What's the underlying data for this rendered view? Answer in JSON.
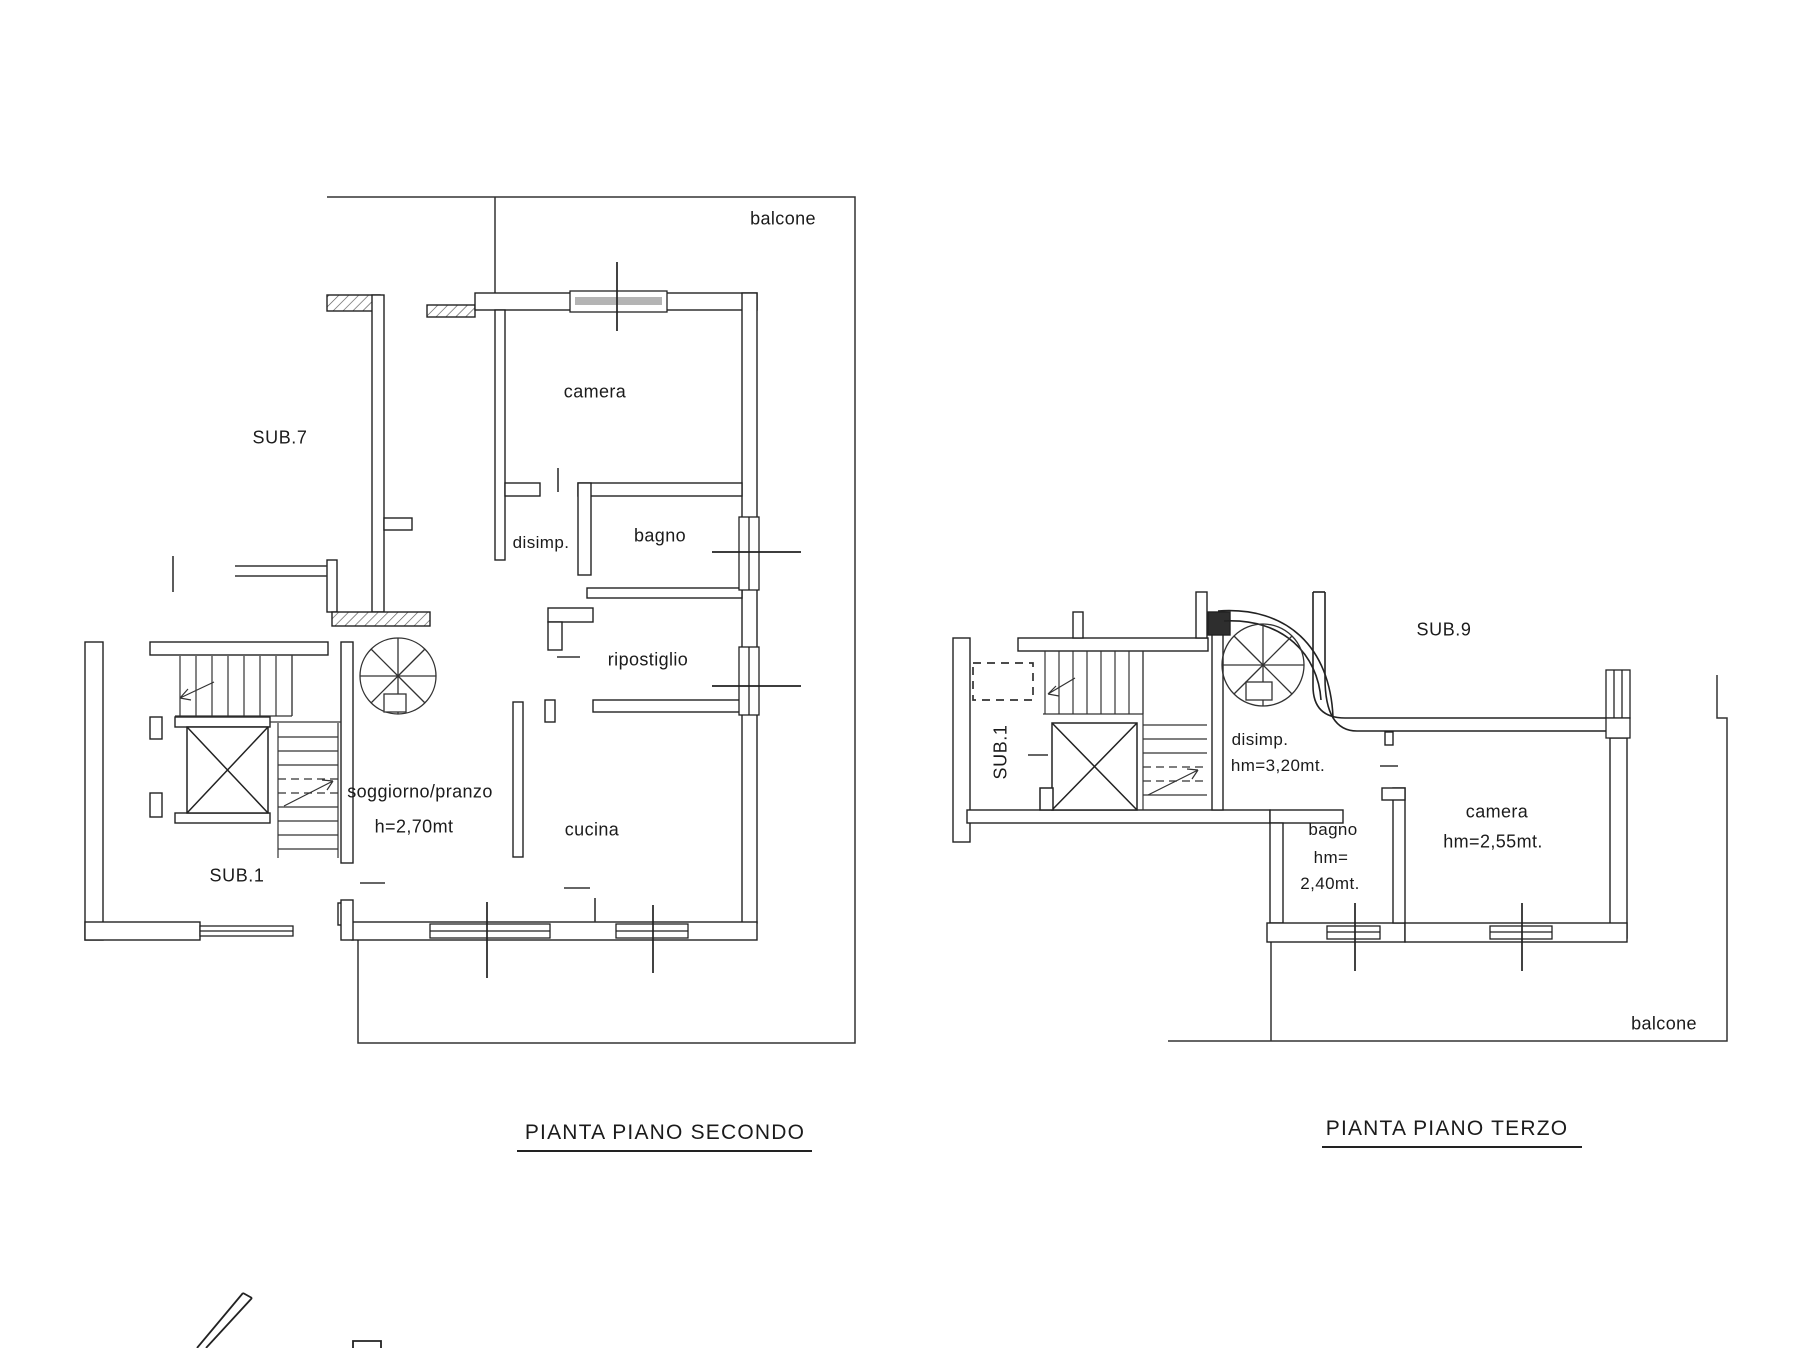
{
  "sheet": {
    "background": "#ffffff",
    "line_color": "#222222",
    "type_note": "scanned architectural floor plan, two plans side by side"
  },
  "plan2": {
    "caption": "PIANTA PIANO SECONDO",
    "balcone": "balcone",
    "sub7": "SUB.7",
    "sub1": "SUB.1",
    "camera": "camera",
    "disimp": "disimp.",
    "bagno": "bagno",
    "ripostiglio": "ripostiglio",
    "soggiorno": "soggiorno/pranzo",
    "soggiorno_h": "h=2,70mt",
    "cucina": "cucina"
  },
  "plan3": {
    "caption": "PIANTA PIANO TERZO",
    "balcone": "balcone",
    "sub9": "SUB.9",
    "sub1": "SUB.1",
    "disimp": "disimp.",
    "disimp_h": "hm=3,20mt.",
    "bagno": "bagno",
    "bagno_h1": "hm=",
    "bagno_h2": "2,40mt.",
    "camera": "camera",
    "camera_h": "hm=2,55mt."
  }
}
